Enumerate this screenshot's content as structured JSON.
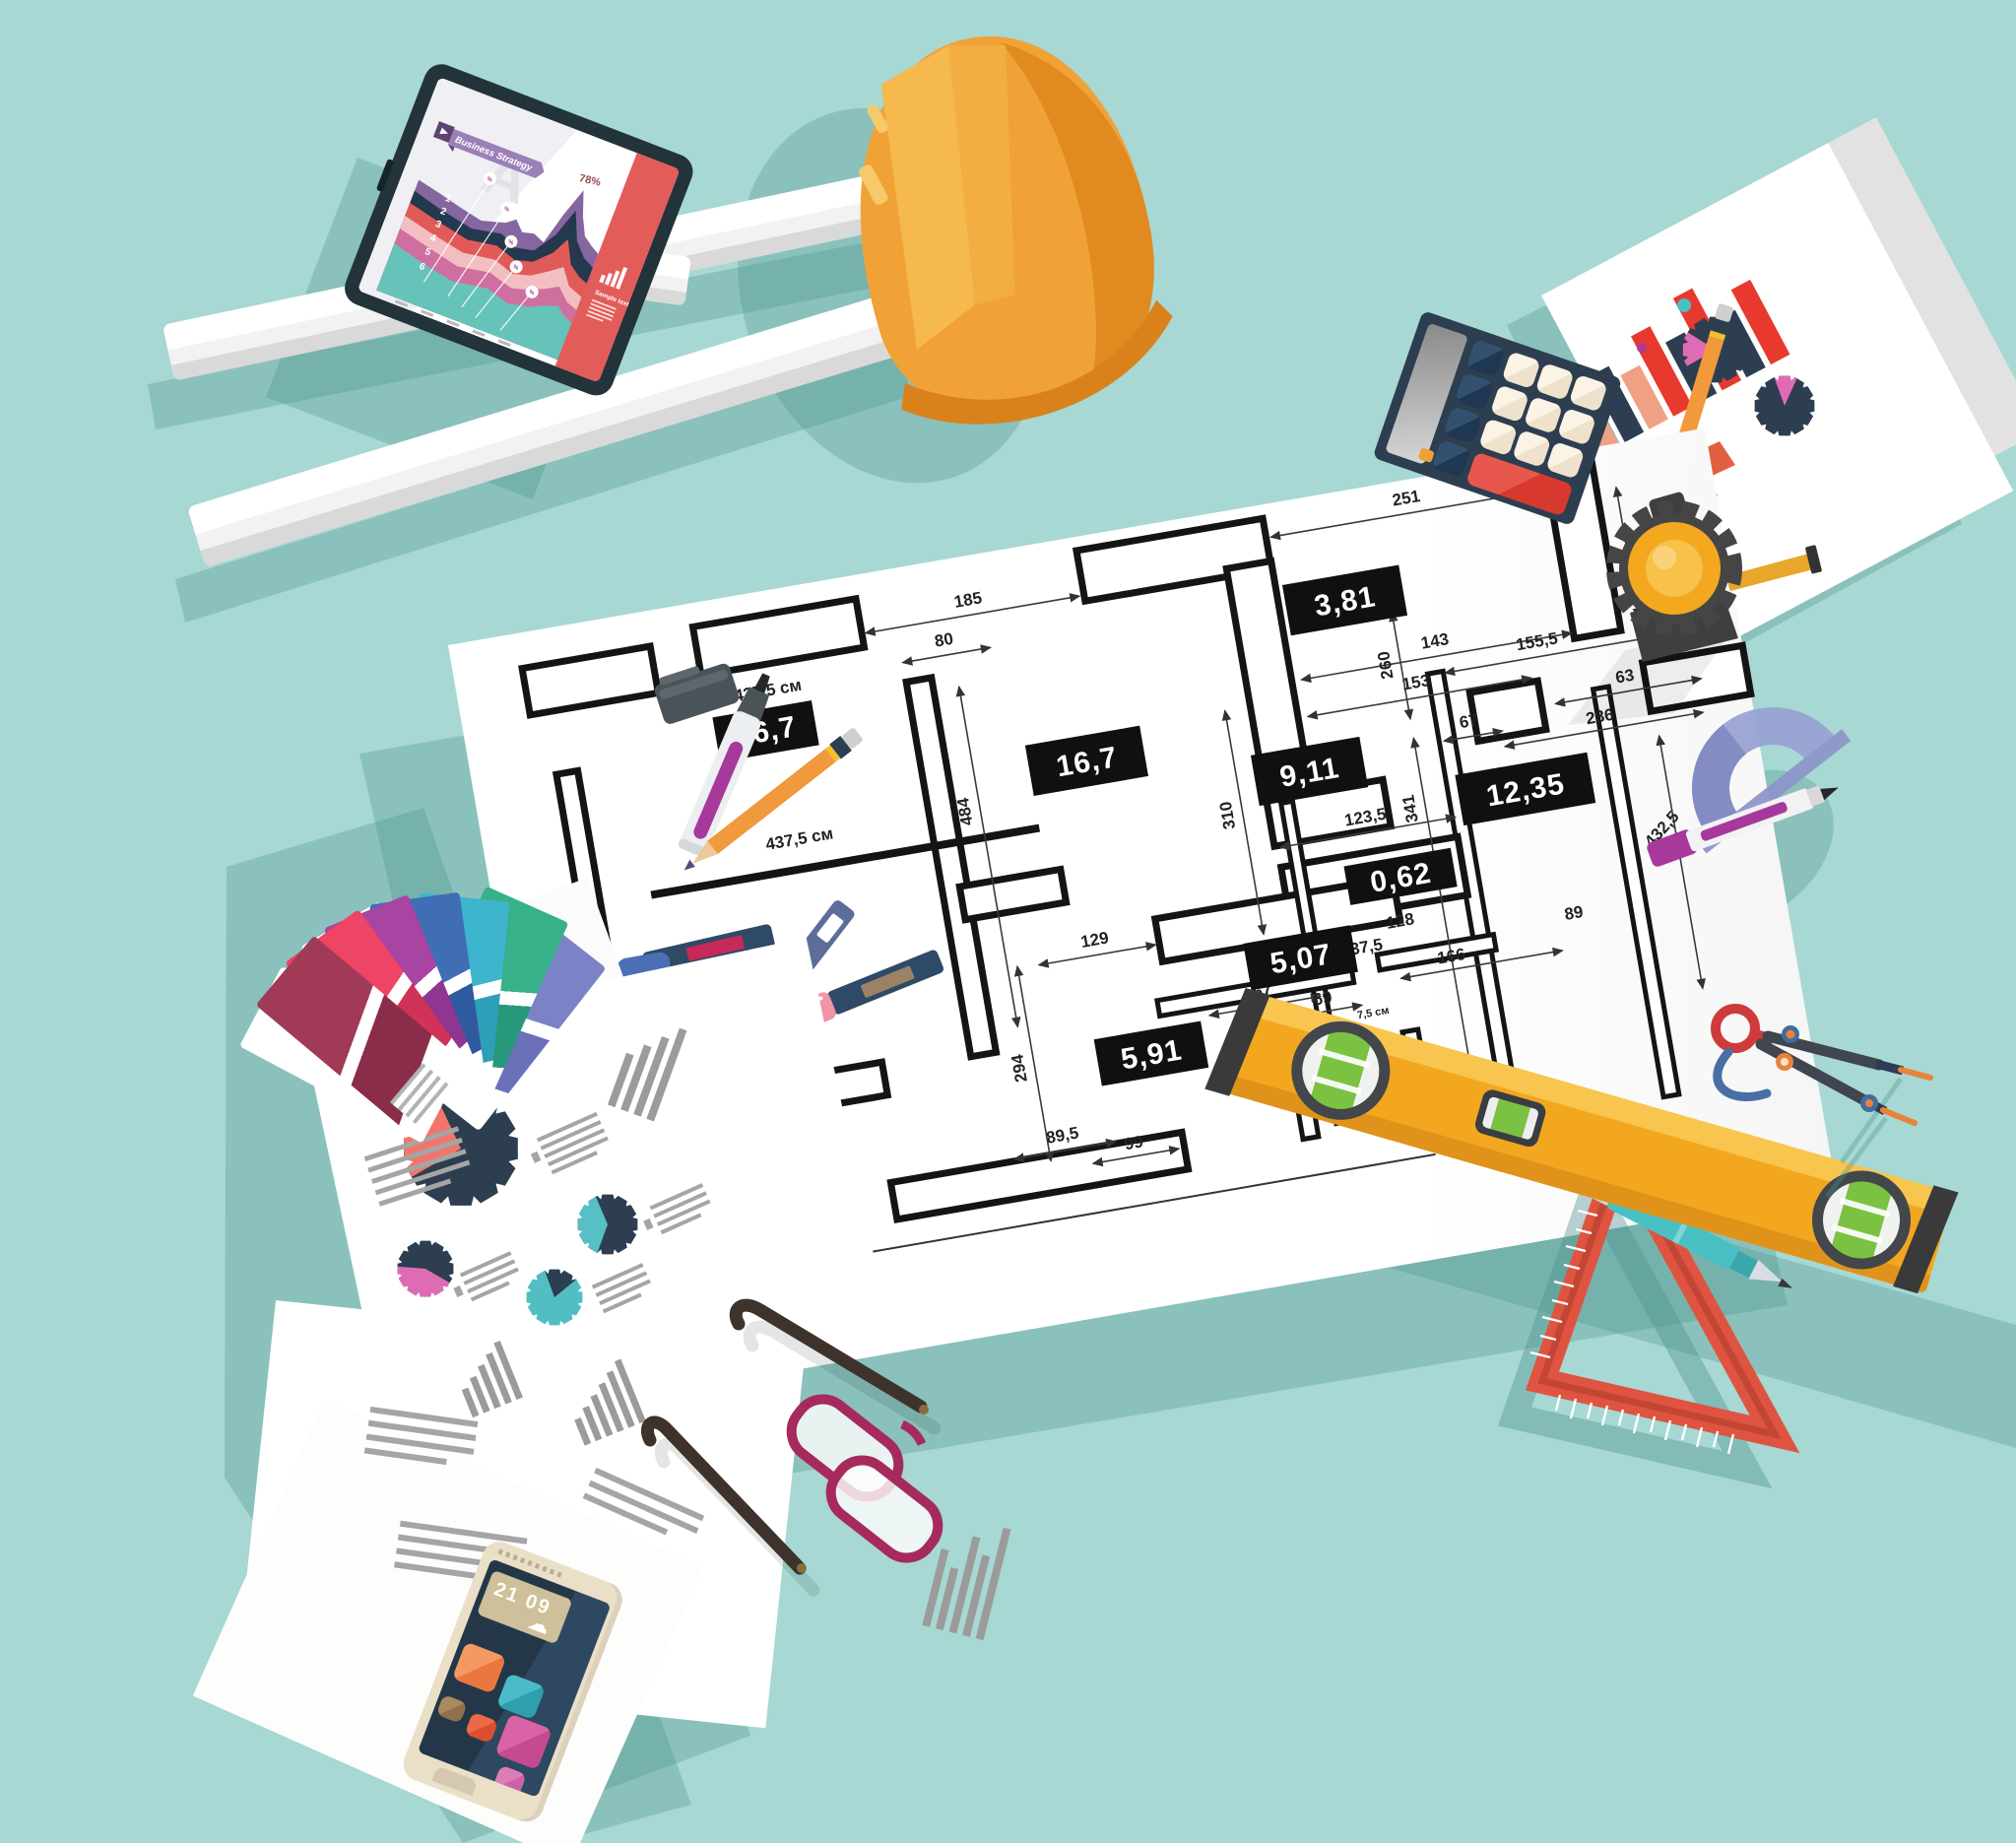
{
  "scene": {
    "description": "Flat-design top view of an architect workspace with blueprint and tools"
  },
  "colors": {
    "background": "#a7d8d3",
    "shadow": "rgba(78,146,140,0.32)",
    "hardhat": "#f0a237",
    "level_yellow": "#f3a81f",
    "calculator_body": "#2d3e50",
    "calculator_red_key": "#e0473f",
    "tablet_bezel": "#22343a",
    "sidebar_red": "#e25c5a",
    "triangle_red": "#df5440",
    "teal_pen": "#49c0c4",
    "protractor_blue": "#99a2d2",
    "marker_magenta": "#a6399b",
    "glasses_frame": "#a62a5e",
    "phone_case": "#eadfc7",
    "vial_green": "#7cc242"
  },
  "icons": {
    "tablet_sidebar": "bar-chart-icon",
    "tablet_ribbon": "tag-icon",
    "phone_wid": "cloud-icon"
  },
  "tablet": {
    "watermark": "A",
    "ribbon_label": "Business Strategy",
    "peak_value": "78%",
    "badge_symbol": "%",
    "layer_numbers": [
      "1",
      "2",
      "3",
      "4",
      "5",
      "6"
    ],
    "sidebar_text": "Sample text"
  },
  "blueprint": {
    "areas": {
      "a16_7": "16,7",
      "a16_7b": "16,7",
      "a3_81": "3,81",
      "a9_11": "9,11",
      "a12_35": "12,35",
      "a0_62": "0,62",
      "a5_07": "5,07",
      "a5_91": "5,91"
    },
    "dims": {
      "d185": "185",
      "d251": "251",
      "d152": "152",
      "d80": "80",
      "d143": "143",
      "d153": "153",
      "d155_5": "155,5",
      "d63": "63",
      "d67a": "67",
      "d286": "286",
      "d260": "260",
      "d341": "341",
      "d310": "310",
      "d484": "484",
      "d432_5": "432,5",
      "d123_5": "123,5",
      "d128": "128",
      "d437_5": "437,5",
      "d89": "89",
      "d166": "166",
      "d129": "129",
      "d294": "294",
      "d89_5": "89,5",
      "d99": "99",
      "d67b": "67",
      "d69": "69",
      "d7_5a": "7,5 см",
      "d7_5b": "7,5 см",
      "u437a": "437,5 см",
      "u437b": "437,5 см"
    }
  },
  "phone": {
    "lock_time": "21 09"
  }
}
